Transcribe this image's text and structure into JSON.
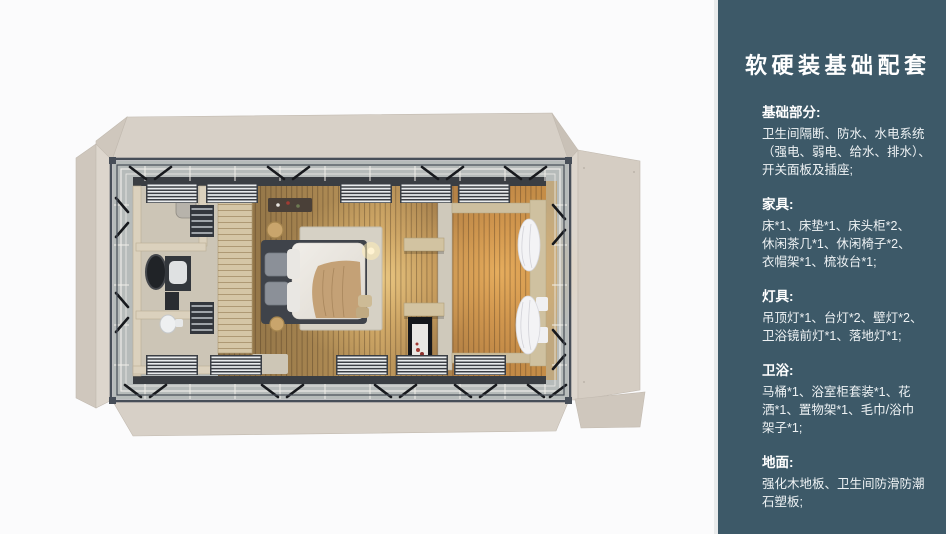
{
  "page": {
    "background": "#fbfbfc"
  },
  "sidebar": {
    "bg_color": "#3d5968",
    "edge_color": "#e9ebec",
    "text_color": "#ffffff",
    "title": "软硬装基础配套",
    "sections": [
      {
        "heading": "基础部分:",
        "body": "卫生间隔断、防水、水电系统\n（强电、弱电、给水、排水）、\n开关面板及插座;"
      },
      {
        "heading": "家具:",
        "body": "床*1、床垫*1、床头柜*2、\n休闲茶几*1、休闲椅子*2、\n衣帽架*1、梳妆台*1;"
      },
      {
        "heading": "灯具:",
        "body": "吊顶灯*1、台灯*2、壁灯*2、\n卫浴镜前灯*1、落地灯*1;"
      },
      {
        "heading": "卫浴:",
        "body": "马桶*1、浴室柜套装*1、花\n洒*1、置物架*1、毛巾/浴巾\n架子*1;"
      },
      {
        "heading": "地面:",
        "body": "强化木地板、卫生间防滑防潮\n石塑板;"
      }
    ]
  },
  "floorplan": {
    "colors": {
      "panel_beige": "#d7d0c7",
      "panel_shadow": "#cfc7bd",
      "panel_light": "#ddd6cd",
      "panel_taupe": "#d5cdc3",
      "frame_steel": "#474e58",
      "brace_black": "#17191d",
      "deck_gray": "#b6bbba",
      "rail_white": "#edece8",
      "wall_dark": "#3a3e43",
      "floor_wood": "#a8824e",
      "floor_glow": "#ffdf96",
      "bathroom_floor": "#ccc5b6",
      "partition_wood": "#d5c6a6",
      "rug": "#d6d1c5",
      "bed_frame": "#3f434a",
      "bed_duvet": "#ebe8e2",
      "throw_blanket": "#c4a176",
      "curtain_white": "#f3f3f5"
    }
  }
}
